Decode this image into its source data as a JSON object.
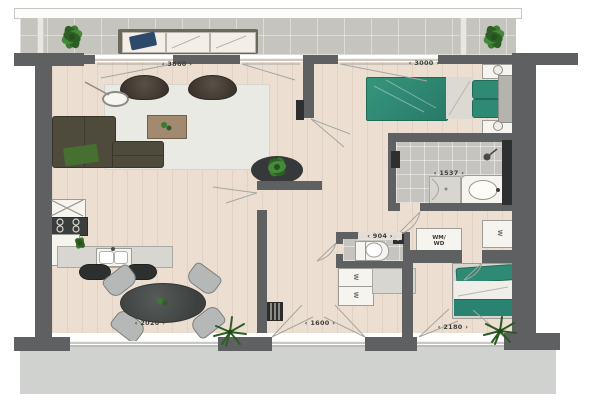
{
  "floorplan": {
    "dimension_labels": {
      "living_room_width": "3860",
      "bedroom_width": "3000",
      "bathroom_width": "1537",
      "wc_width": "904",
      "kitchen_window": "2020",
      "hall_doors": "1600",
      "bedroom2_window": "2180"
    },
    "appliances": {
      "washer_dryer": "WM/\nWD",
      "wardrobe_marker": "W"
    },
    "colors": {
      "wall": "#5e6062",
      "wall-dark": "#2e2f30",
      "wood": "#ecdfd2",
      "tile": "#c6c4bf",
      "rug": "#e9eae4",
      "teal": "#2f8a74",
      "sofa": "#4e4b3c",
      "seat": "#b5b8b6",
      "counter": "#d8d6d1",
      "pavement": "#cfd2cf",
      "wood-table": "#a28a71"
    }
  }
}
